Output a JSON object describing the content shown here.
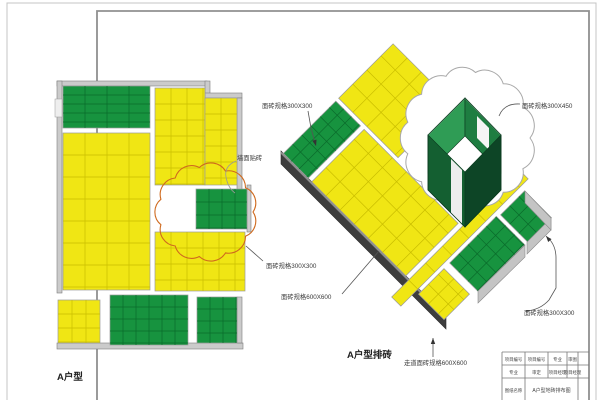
{
  "drawing": {
    "labels": {
      "plan": "A户型",
      "iso": "A户型排砖"
    },
    "annotations": {
      "wall_tile": "墙面贴砖",
      "spec_balcony": "面砖规格300X300",
      "spec_box": "面砖规格300X450",
      "spec_bath": "面砖规格300X300",
      "spec_floor": "面砖规格600X600",
      "spec_kitchen": "面砖规格300X300",
      "walkway": "走道面砖规格600X600"
    },
    "title_block": {
      "row1": [
        "项目编号",
        "项目编号",
        "专业",
        "审图"
      ],
      "row2": [
        "专业",
        "审定",
        "项目经理",
        "项目经理"
      ],
      "row3_label": "图纸名称",
      "row3_value": "A户型地砖排布图"
    },
    "colors": {
      "tile_yellow": "#f0e614",
      "tile_yellow_line": "#c9bd00",
      "tile_green": "#17933f",
      "tile_green_line": "#0a6b2b",
      "box_inner_nw": "#2f9c55",
      "box_inner_ne": "#1e7d41",
      "box_outer_sw": "#145f31",
      "box_outer_se": "#0d4526",
      "slab_dark": "#3d3d3d",
      "slab_light": "#c4c4c4",
      "cloud_orange": "#cf6a1e",
      "wall_gray": "#cbcbcb",
      "leader": "#555555",
      "frame": "#9a9a9a"
    }
  }
}
